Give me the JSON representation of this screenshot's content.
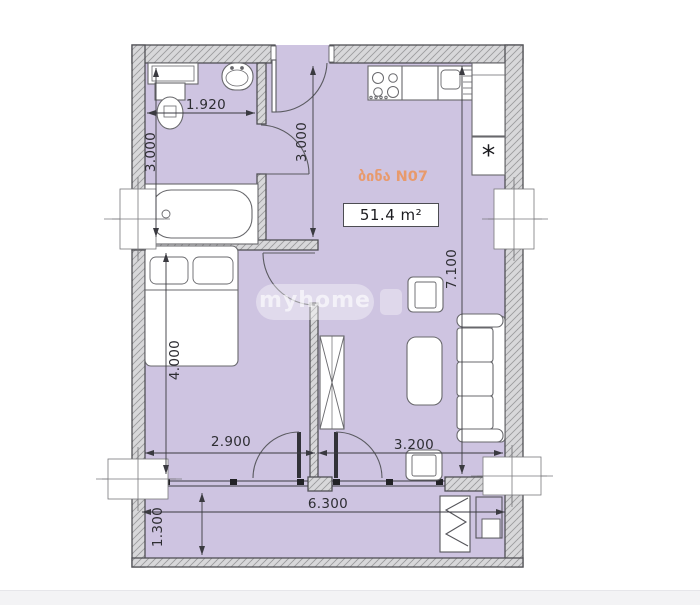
{
  "plan": {
    "apartment_label": "ბინა N07",
    "area_label": "51.4 m²",
    "watermark": "myhome",
    "fridge_symbol": "*",
    "dimensions": {
      "bathroom_width": "1.920",
      "bathroom_depth": "3.000",
      "hall_depth": "3.000",
      "bedroom_depth": "4.000",
      "bedroom_width": "2.900",
      "living_depth": "7.100",
      "living_width": "3.200",
      "balcony_width": "6.300",
      "balcony_depth": "1.300"
    },
    "colors": {
      "floor": "#cec4e1",
      "wall_fill": "#d8d8da",
      "wall_hatch": "#9b9b9d",
      "outline": "#505055",
      "furniture_stroke": "#68686c",
      "label_orange": "#e89a6c",
      "dim_text": "#2e2e33"
    }
  }
}
